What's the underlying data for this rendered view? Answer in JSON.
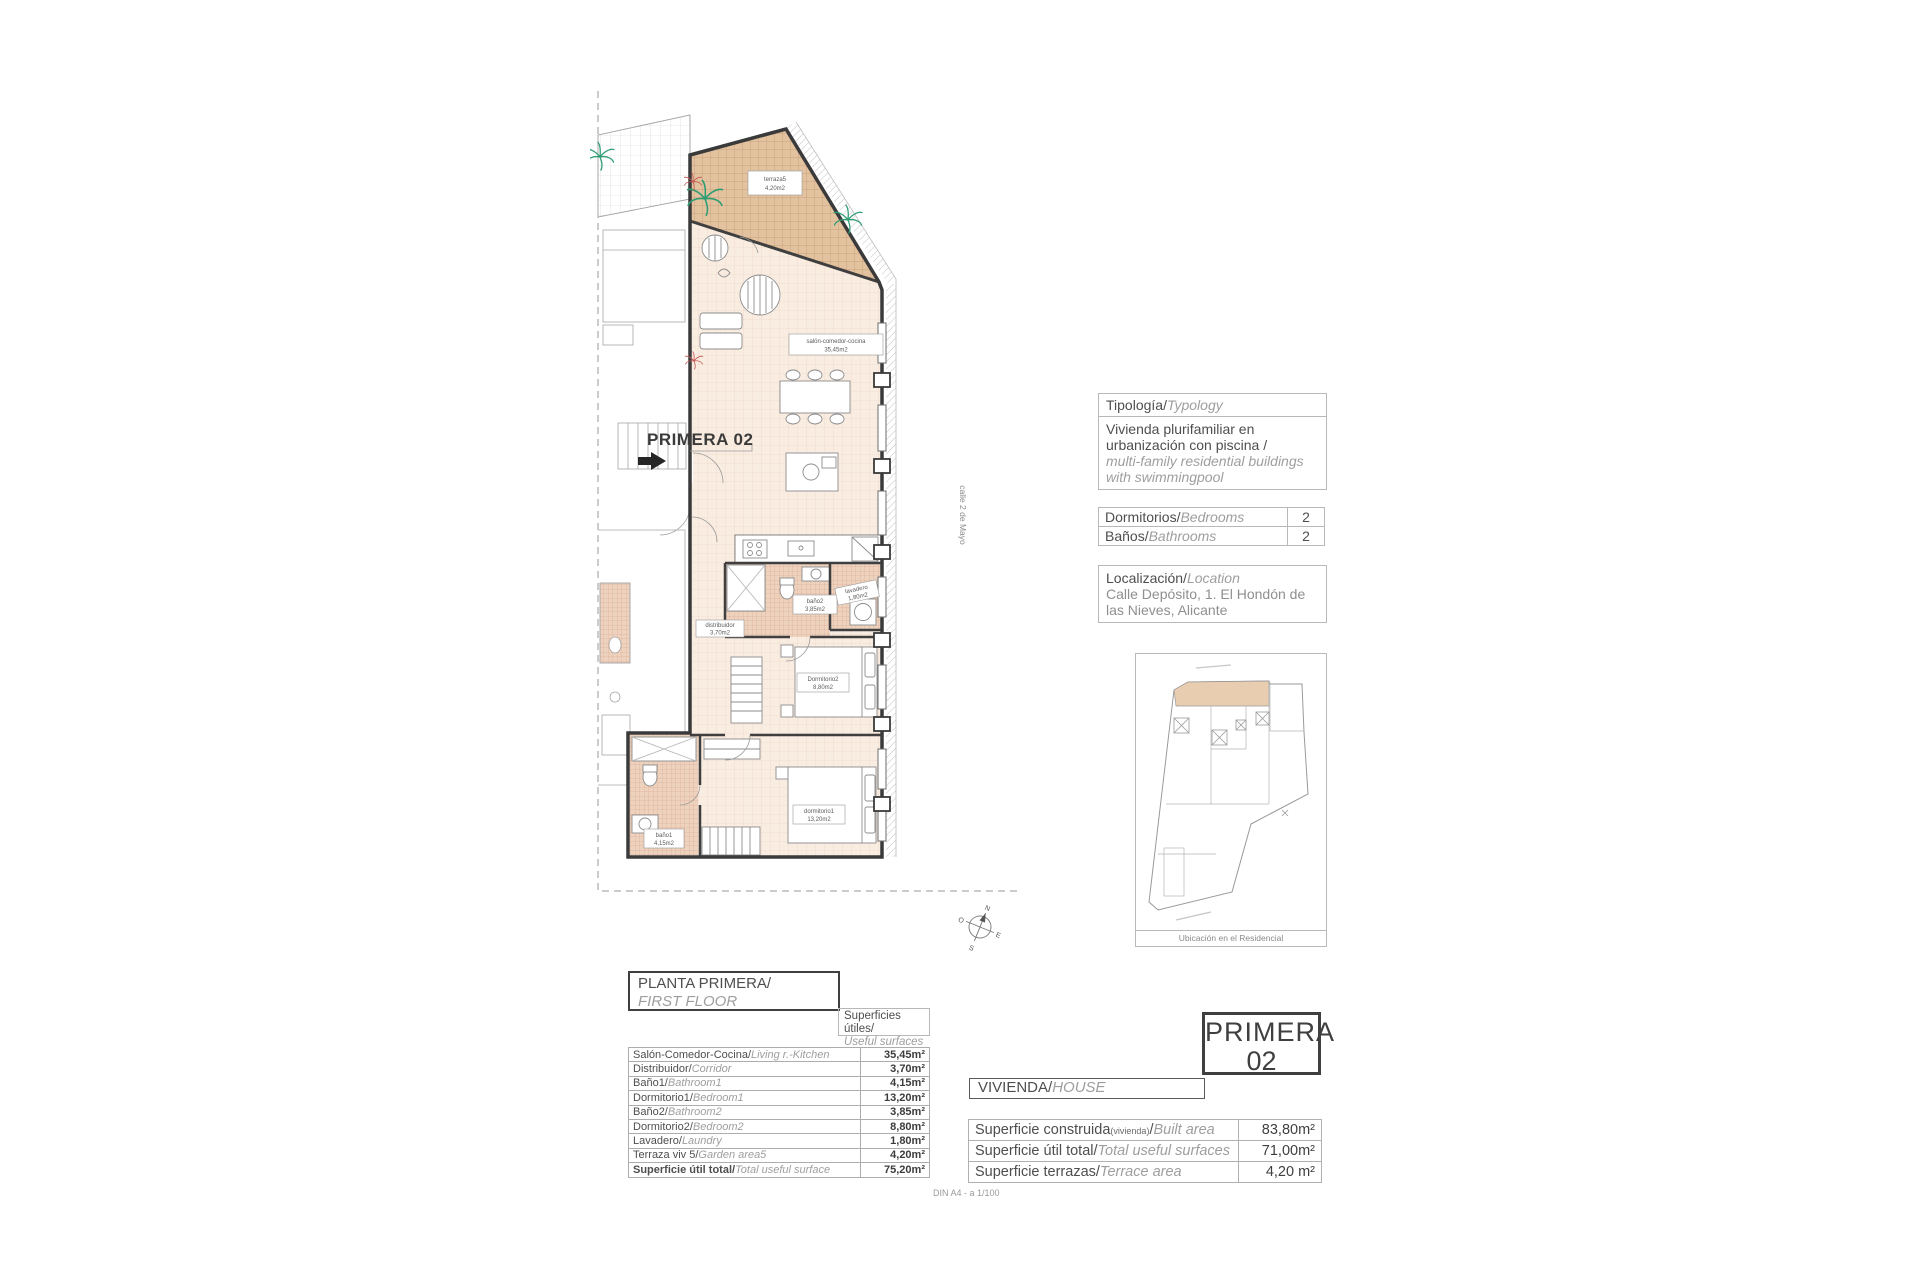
{
  "colors": {
    "wall": "#3a3a3a",
    "floor": "#f9ece1",
    "terrace": "#e3c2a0",
    "tile": "#edd2bd",
    "site_highlight": "#e9cdb0",
    "plant_green": "#2f9e74",
    "plant_red": "#c4524e"
  },
  "plan": {
    "unit_label": "PRIMERA 02",
    "street": "calle 2 de Mayo",
    "compass": {
      "n": "N",
      "s": "S",
      "e": "E",
      "o": "O"
    },
    "labels": {
      "terraza": {
        "l1": "terraza5",
        "l2": "4,20m2"
      },
      "salon": {
        "l1": "salón-comedor-cocina",
        "l2": "35,45m2"
      },
      "bano2": {
        "l1": "baño2",
        "l2": "3,85m2"
      },
      "lavadero": {
        "l1": "lavadero",
        "l2": "1,80m2"
      },
      "distribuidor": {
        "l1": "distribuidor",
        "l2": "3,70m2"
      },
      "dormitorio2": {
        "l1": "Dormitorio2",
        "l2": "8,80m2"
      },
      "dormitorio1": {
        "l1": "dormitorio1",
        "l2": "13,20m2"
      },
      "bano1": {
        "l1": "baño1",
        "l2": "4,15m2"
      }
    }
  },
  "typology": {
    "title_es": "Tipología/",
    "title_en": "Typology",
    "body_es": "Vivienda plurifamiliar en urbanización con piscina  /",
    "body_en": "multi-family residential buildings with swimmingpool"
  },
  "rooms_table": {
    "rows": [
      {
        "es": "Dormitorios/",
        "en": "Bedrooms",
        "value": "2"
      },
      {
        "es": "Baños/",
        "en": "Bathrooms",
        "value": "2"
      }
    ]
  },
  "location": {
    "title_es": "Localización/",
    "title_en": "Location",
    "body": "Calle Depósito, 1. El Hondón de las Nieves, Alicante"
  },
  "site_plan": {
    "caption": "Ubicación en el Residencial"
  },
  "floor_header": {
    "es": "PLANTA PRIMERA/",
    "en": "FIRST FLOOR"
  },
  "surfaces_header": {
    "es": "Superficies útiles/",
    "en": "Useful surfaces"
  },
  "surfaces": {
    "rows": [
      {
        "es": "Salón-Comedor-Cocina/",
        "en": "Living r.-Kitchen",
        "value": "35,45m²"
      },
      {
        "es": "Distribuidor/",
        "en": "Corridor",
        "value": "3,70m²"
      },
      {
        "es": "Baño1/",
        "en": "Bathroom1",
        "value": "4,15m²"
      },
      {
        "es": "Dormitorio1/",
        "en": "Bedroom1",
        "value": "13,20m²"
      },
      {
        "es": "Baño2/",
        "en": "Bathroom2",
        "value": "3,85m²"
      },
      {
        "es": "Dormitorio2/",
        "en": "Bedroom2",
        "value": "8,80m²"
      },
      {
        "es": "Lavadero/",
        "en": "Laundry",
        "value": "1,80m²"
      },
      {
        "es": "Terraza viv 5/",
        "en": "Garden area5",
        "value": "4,20m²"
      },
      {
        "es": "Superficie útil total/",
        "en": "Total useful surface",
        "value": "75,20m²"
      }
    ]
  },
  "unit_card": {
    "line1": "PRIMERA",
    "line2": "02"
  },
  "dwelling": {
    "es": "VIVIENDA/",
    "en": "HOUSE"
  },
  "totals": {
    "rows": [
      {
        "es": "Superficie construida",
        "sub": "(vivienda)",
        "sep": "/",
        "en": "Built area",
        "value": "83,80m²"
      },
      {
        "es": "Superficie útil total",
        "sub": "",
        "sep": "/",
        "en": "Total useful surfaces",
        "value": "71,00m²"
      },
      {
        "es": "Superficie terrazas",
        "sub": "",
        "sep": "/",
        "en": "Terrace area",
        "value": "4,20 m²"
      }
    ]
  },
  "scale_note": "DIN A4 - a 1/100"
}
